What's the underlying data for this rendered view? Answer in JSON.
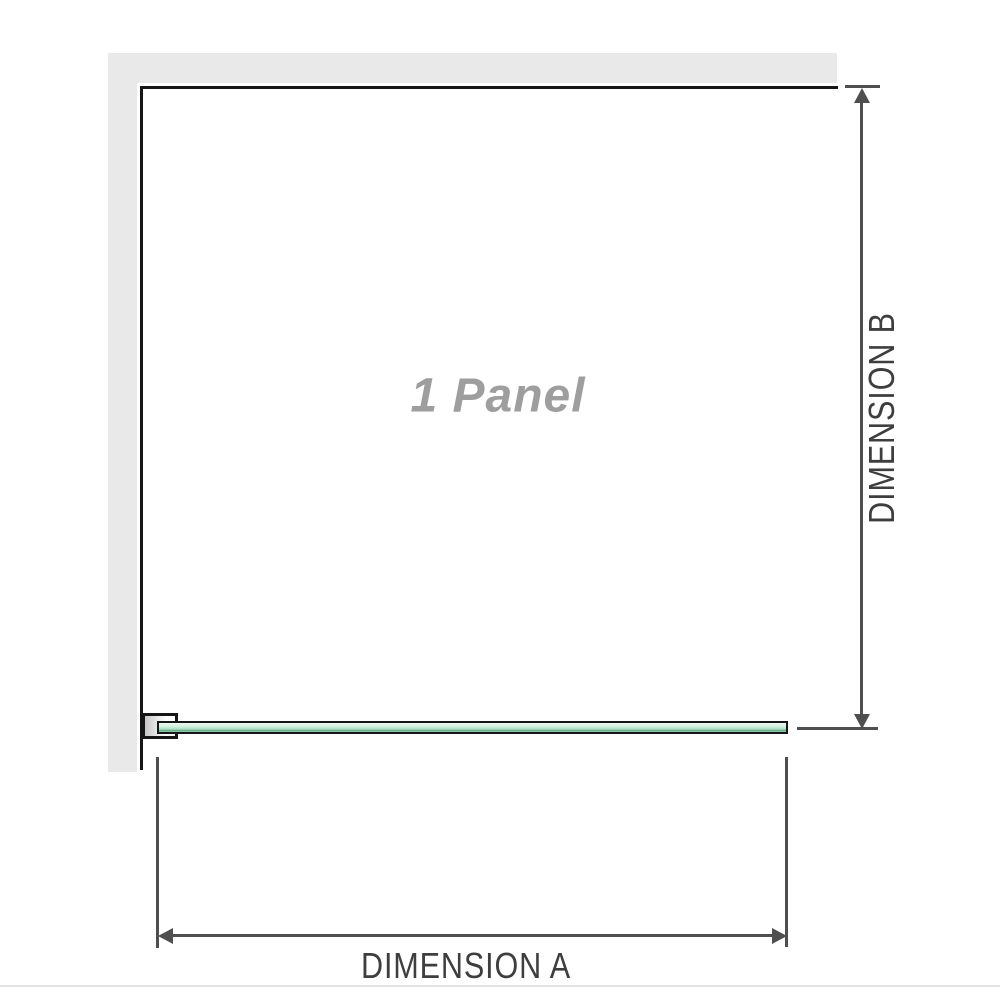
{
  "diagram": {
    "panel_label": "1 Panel",
    "dimension_a": {
      "label": "DIMENSION A"
    },
    "dimension_b": {
      "label": "DIMENSION B"
    }
  },
  "colors": {
    "wall_gray": "#e9e9e9",
    "outline_black": "#161616",
    "dimension_line_gray": "#4f4f4f",
    "dimension_text_gray": "#3e3e3e",
    "panel_label_gray": "#9e9e9e",
    "glass_green_light": "#eef8f1",
    "glass_green_mid": "#a9dfc1",
    "glass_green_dark": "#5da37e",
    "rule_gray": "#e3e3e3"
  }
}
